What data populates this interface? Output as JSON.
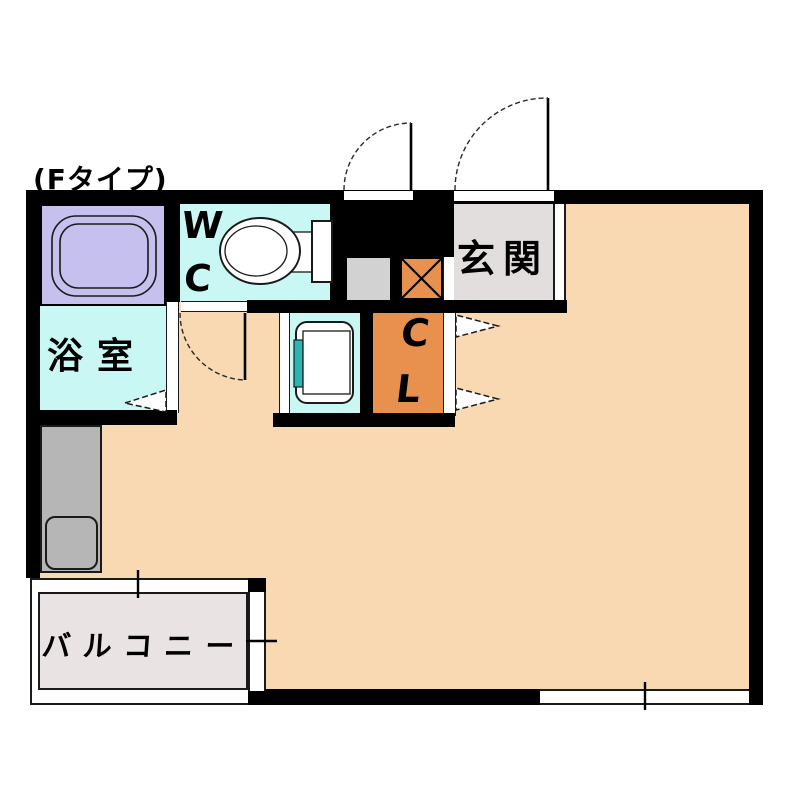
{
  "floor_plan": {
    "type_label": "(Fタイプ)",
    "rooms": {
      "bathroom": {
        "label": "浴室"
      },
      "toilet": {
        "label": "WC"
      },
      "entrance": {
        "label": "玄関"
      },
      "closet": {
        "label": "CL"
      },
      "balcony": {
        "label": "バルコニー"
      }
    },
    "colors": {
      "wall": "#000000",
      "outline": "#1a1a1a",
      "room_floor": "#f8d9b1",
      "wet_area": "#c9f7f4",
      "bathtub_area": "#c6c0ee",
      "closet_fill": "#e8914e",
      "entrance_floor": "#e2dede",
      "balcony_floor": "#e9e3e3",
      "kitchen_counter": "#b6b6b6",
      "shaft_box": "#d2d2d2",
      "washer_accent": "#2ab5b5",
      "fixture_fill": "#ffffff"
    }
  }
}
